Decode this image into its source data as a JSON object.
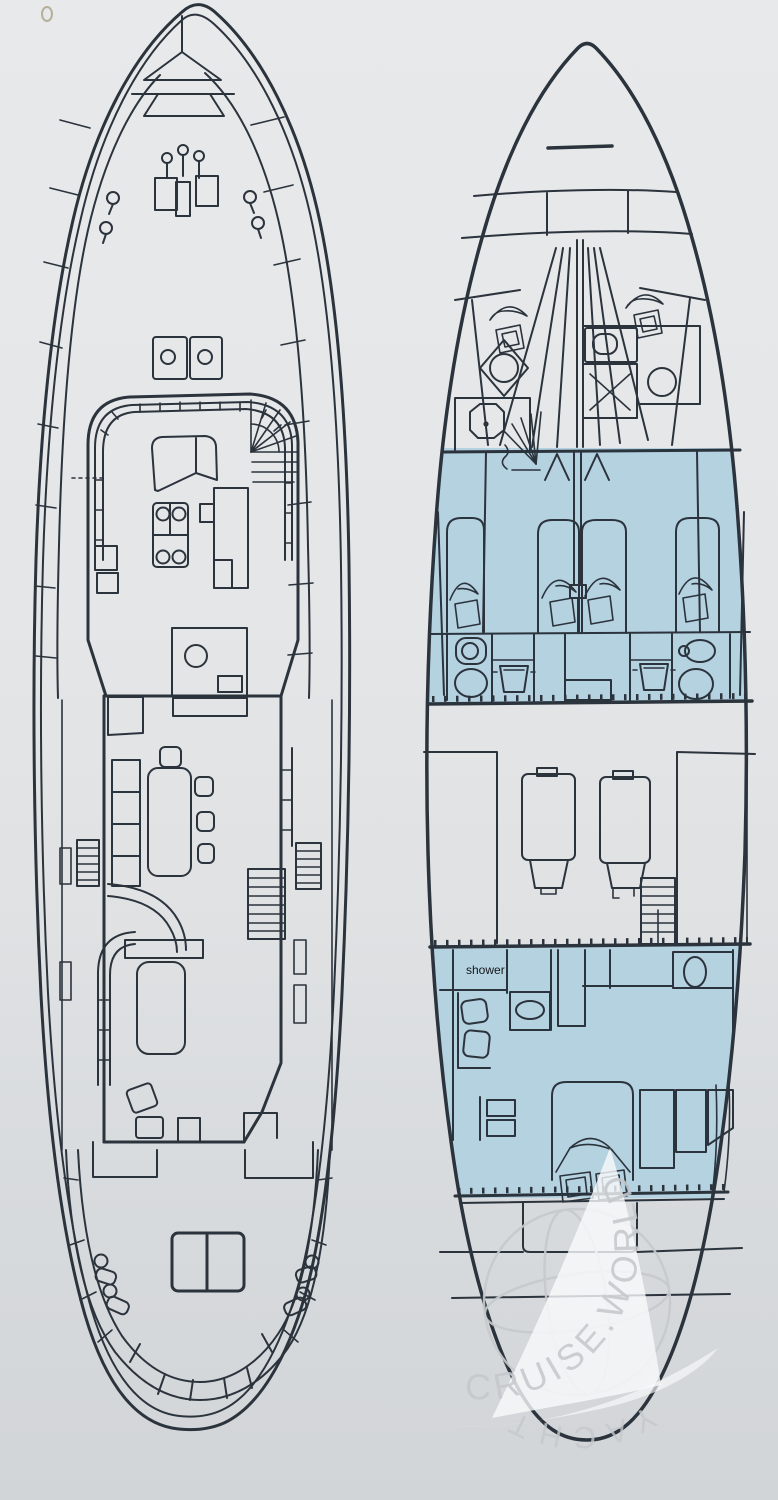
{
  "palette": {
    "background_top": "#e8e9eb",
    "background_bottom": "#d2d5d8",
    "ink": "#2b333c",
    "cabin_blue": "#b5d2e1",
    "watermark_gray": "#c5c9cd",
    "sail_white": "#f9fafb"
  },
  "plans": {
    "main_deck": {
      "description": "main deck plan"
    },
    "lower_deck": {
      "description": "lower deck plan",
      "shower_label": "shower"
    }
  },
  "watermark": {
    "ring_text": "CRUISE.WORLD",
    "bottom_text": "YACHT"
  }
}
